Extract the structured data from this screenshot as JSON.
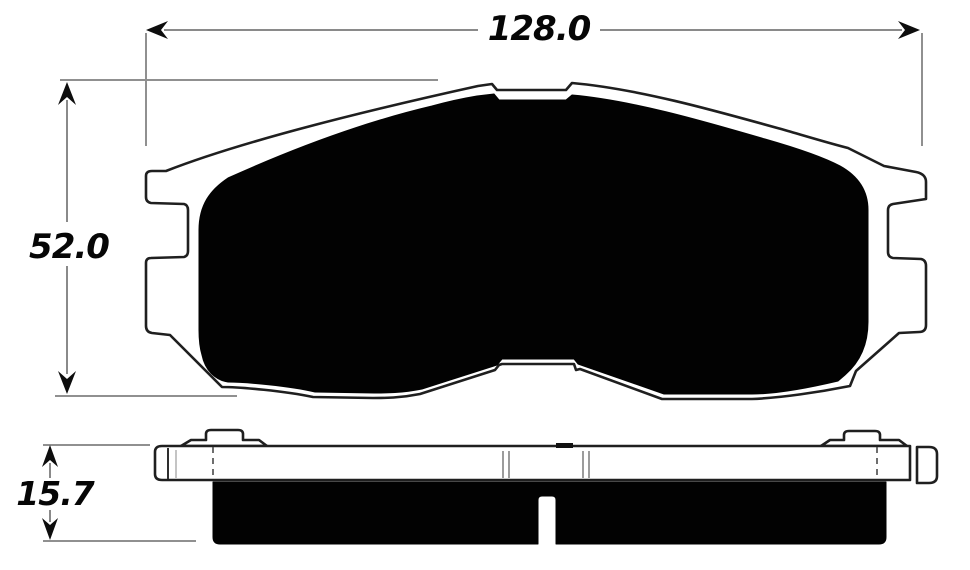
{
  "page": {
    "background": "#ffffff"
  },
  "diagram": {
    "dimensions": {
      "width": {
        "value": "128.0"
      },
      "height": {
        "value": "52.0"
      },
      "thickness": {
        "value": "15.7"
      }
    },
    "colors": {
      "ink": "#000000",
      "outline": "#1f1f1f",
      "dimension_line": "#8a8a8a",
      "dash_line": "#4a4a4a",
      "tick": "#7a7a7a",
      "text": "#060606"
    }
  }
}
